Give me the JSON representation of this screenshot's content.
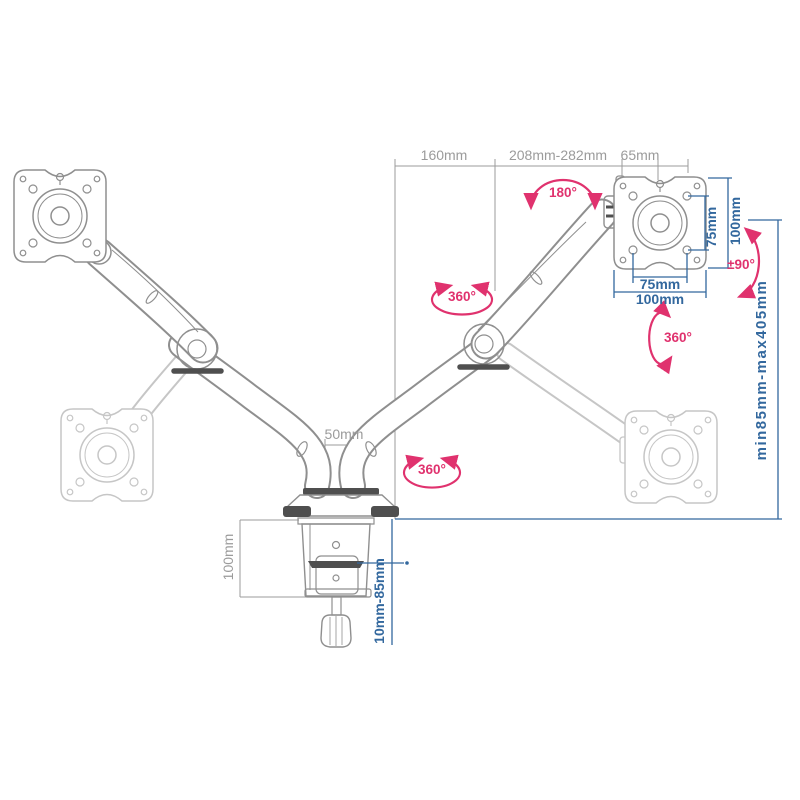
{
  "title": "Dual monitor desk-mount gas-spring arm — dimension diagram",
  "colors": {
    "background": "#ffffff",
    "drawing_outline": "#8f8f8f",
    "ghost_outline": "#c6c6c6",
    "dark_accent": "#4f4f4f",
    "dimension_gray": "#9b9b9b",
    "dimension_blue": "#33689e",
    "rotation_pink": "#e0326e"
  },
  "labels": {
    "reach_left": "160mm",
    "reach_right": "208mm-282mm",
    "vesa_depth": "65mm",
    "pole_width": "50mm",
    "clamp_body_height": "100mm",
    "vesa_hole_vertical": "75mm",
    "vesa_plate_vertical": "100mm",
    "vesa_hole_horizontal": "75mm",
    "vesa_plate_horizontal": "100mm",
    "height_range": "min85mm-max405mm",
    "desk_thickness_range": "10mm-85mm",
    "tilt_arc": "180°",
    "swivel_elbow": "360°",
    "swivel_head": "360°",
    "swivel_base": "360°",
    "plate_rotation": "±90°"
  }
}
